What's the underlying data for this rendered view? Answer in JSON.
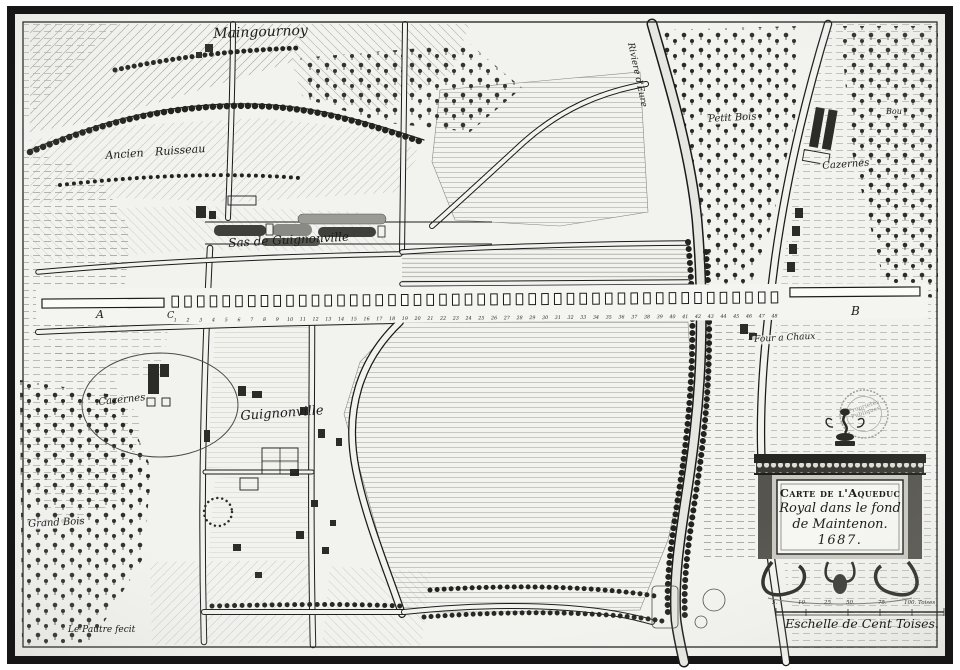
{
  "map": {
    "type": "engraved antique map, black and white, 1687",
    "cartouche": {
      "line1": "Carte de l'Aqueduc",
      "line2": "Royal dans le fond",
      "line3": "de Maintenon.",
      "line4": "1687."
    },
    "scale": {
      "caption": "Eschelle de Cent Toises.",
      "ticks": [
        "5.",
        "10.",
        "25.",
        "50.",
        "75.",
        "100. Toises"
      ]
    },
    "signature": "Le Pautre fecit",
    "stamp": {
      "line1": "Propriétés",
      "line2": "Publiques"
    },
    "labels": {
      "maingournoy": "Maingournoy",
      "ancien_ruisseau": "Ancien Ruisseau",
      "sas": "Sas de Guignonville",
      "riviere": "Riviere d'Eure",
      "petit_bois": "Petit Bois",
      "bou": "Bou",
      "cazernes_right": "Cazernes",
      "four_a_chaux": "Four a Chaux",
      "cazernes_left": "Cazernes",
      "guignonville": "Guignonville",
      "grand_bois": "Grand Bois"
    },
    "aqueduct": {
      "label_left_block": "A",
      "label_first_pier": "C",
      "label_right_block": "B",
      "pier_count": 48,
      "pier_numbers_start": 1
    },
    "colors": {
      "paper": "#f2f2ef",
      "ink": "#1c1c1c",
      "frame": "#161616",
      "shade": "#8d8d87"
    }
  }
}
